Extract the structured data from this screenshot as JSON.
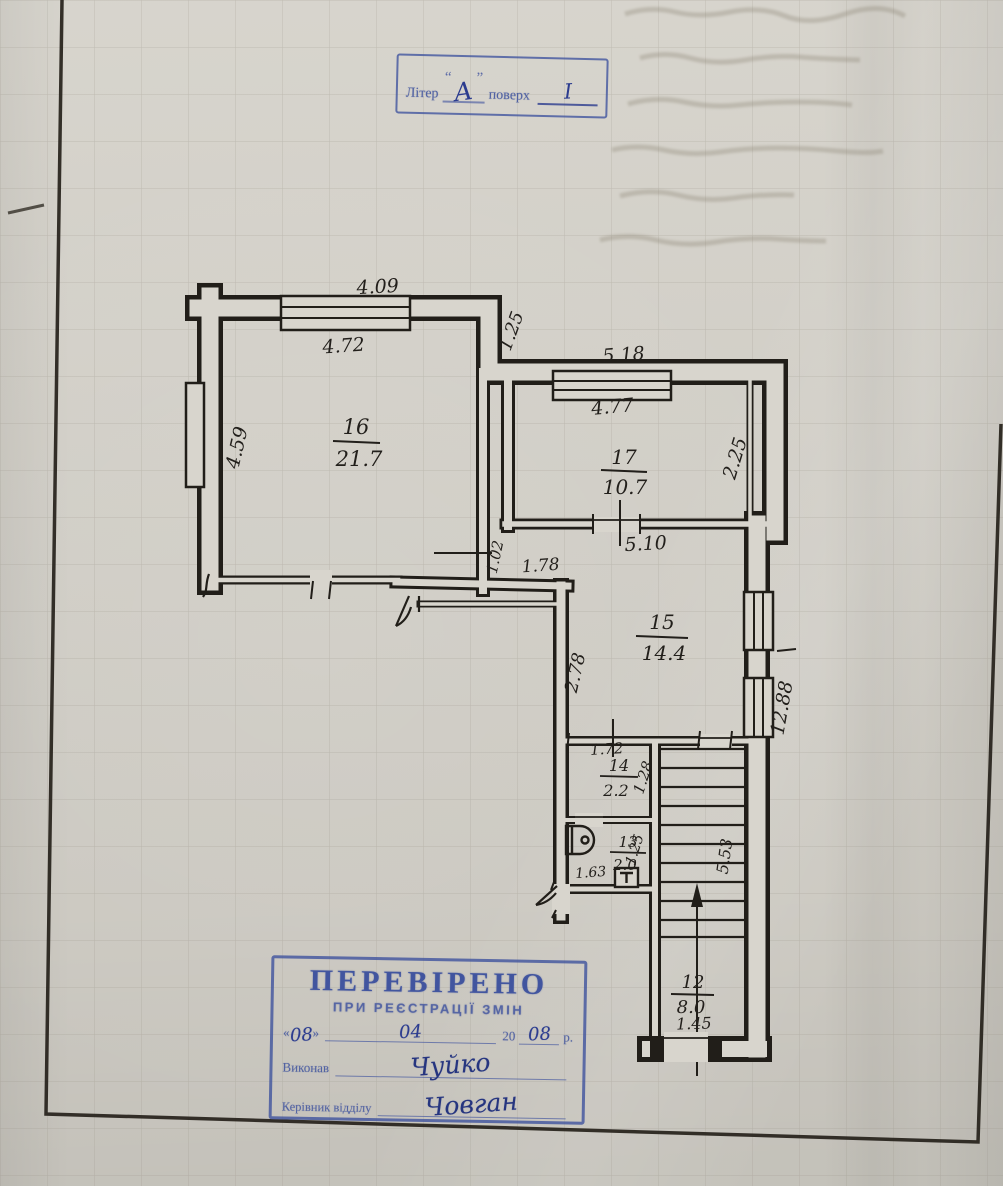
{
  "colors": {
    "paper": "#d5d2ca",
    "ink": "#221f1b",
    "stamp_blue": "#3e529e",
    "hand_ink": "#2c3c8f"
  },
  "top_stamp": {
    "label": "Літер",
    "quote_open": "“",
    "letter": "А",
    "quote_close": "”",
    "word": "поверх",
    "floor": "І"
  },
  "bottom_stamp": {
    "title": "ПЕРЕВІРЕНО",
    "subtitle": "ПРИ РЕЄСТРАЦІЇ ЗМІН",
    "quote_open": "«",
    "day": "08",
    "quote_close": "»",
    "month": "04",
    "year_prefix": "20",
    "year": "08",
    "year_suffix": "р.",
    "executor_label": "Виконав",
    "executor_signature": "Чуйко",
    "head_label": "Керівник відділу",
    "head_signature": "Човган"
  },
  "plan": {
    "rooms": [
      {
        "number": "16",
        "area": "21.7"
      },
      {
        "number": "17",
        "area": "10.7"
      },
      {
        "number": "15",
        "area": "14.4"
      },
      {
        "number": "14",
        "area": "2.2"
      },
      {
        "number": "13",
        "area": "2.0"
      },
      {
        "number": "12",
        "area": "8.0"
      }
    ],
    "dimensions": [
      "4.09",
      "4.72",
      "4.59",
      "1.25",
      "5.18",
      "4.77",
      "2.25",
      "5.10",
      "1.02",
      "1.78",
      "2.78",
      "12.88",
      "1.72",
      "1.28",
      "1.25",
      "1.63",
      "5.53",
      "1.45"
    ]
  }
}
